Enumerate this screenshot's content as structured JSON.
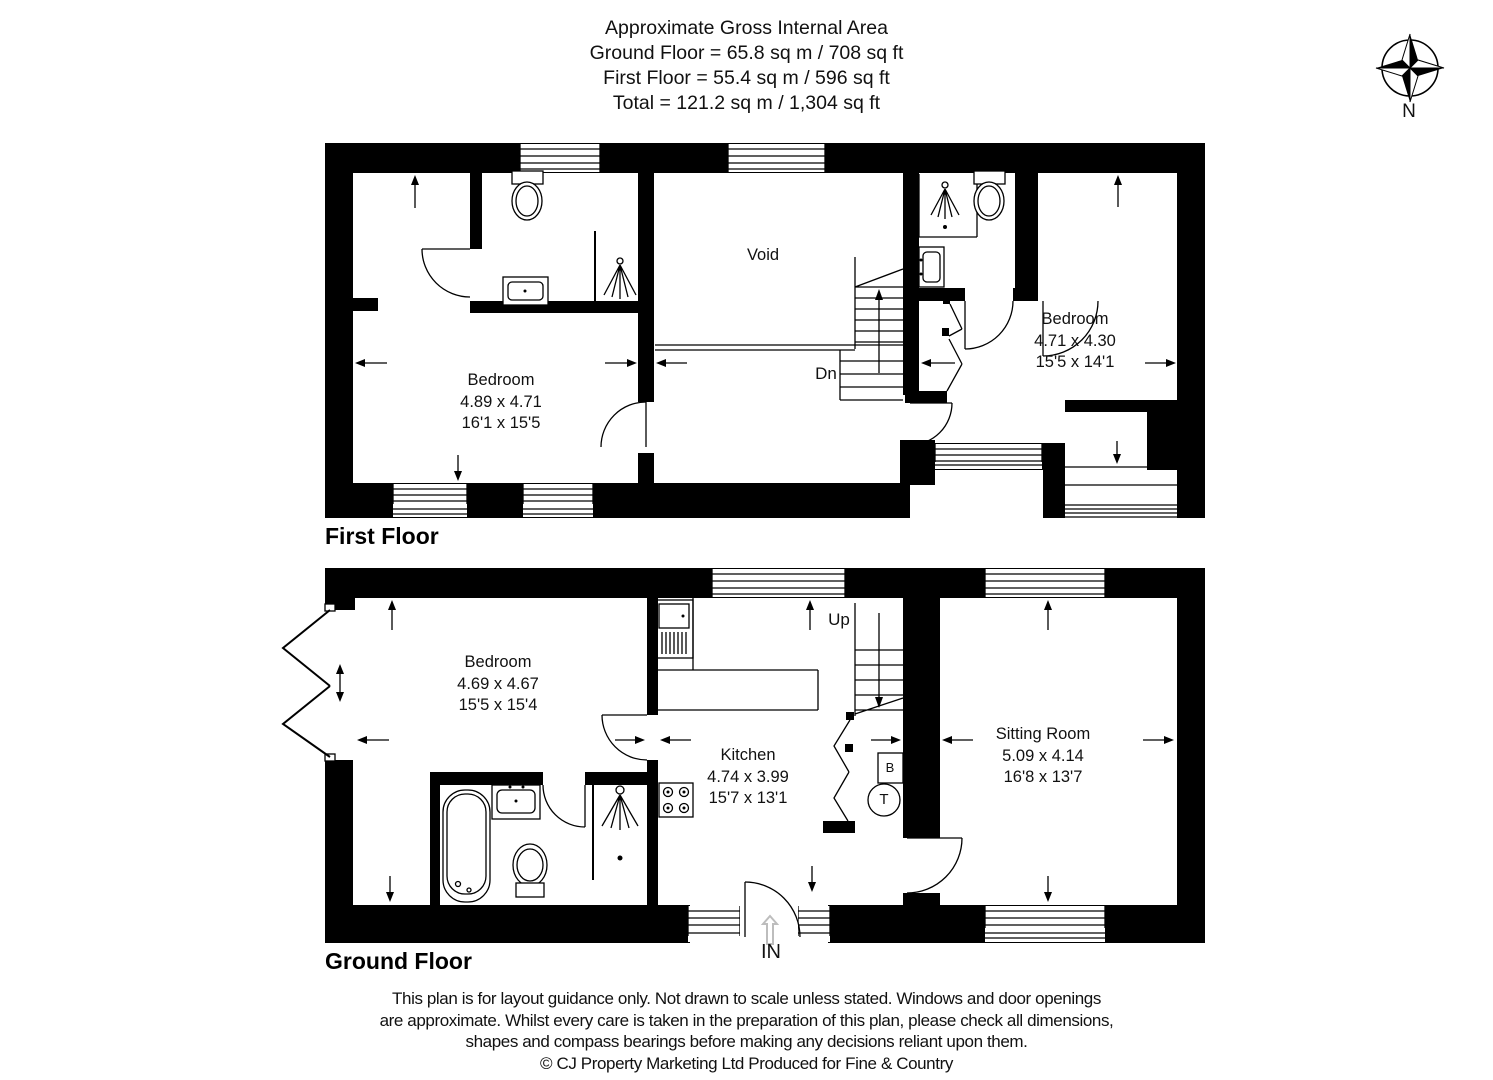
{
  "header": {
    "title": "Approximate Gross Internal Area",
    "ground_floor_area": "Ground Floor = 65.8 sq m / 708 sq ft",
    "first_floor_area": "First Floor = 55.4 sq m / 596 sq ft",
    "total_area": "Total = 121.2 sq m / 1,304 sq ft"
  },
  "compass": {
    "north_label": "N"
  },
  "first_floor": {
    "title": "First Floor",
    "stairs_label": "Dn",
    "rooms": {
      "bedroom_left": {
        "name": "Bedroom",
        "size_m": "4.89 x 4.71",
        "size_ft": "16'1 x 15'5"
      },
      "bedroom_right": {
        "name": "Bedroom",
        "size_m": "4.71 x 4.30",
        "size_ft": "15'5 x 14'1"
      },
      "void": {
        "name": "Void"
      }
    }
  },
  "ground_floor": {
    "title": "Ground Floor",
    "stairs_label": "Up",
    "entrance_label": "IN",
    "boiler_label": "B",
    "tank_label": "T",
    "rooms": {
      "bedroom": {
        "name": "Bedroom",
        "size_m": "4.69 x 4.67",
        "size_ft": "15'5 x 15'4"
      },
      "kitchen": {
        "name": "Kitchen",
        "size_m": "4.74 x 3.99",
        "size_ft": "15'7 x 13'1"
      },
      "sitting_room": {
        "name": "Sitting Room",
        "size_m": "5.09 x 4.14",
        "size_ft": "16'8 x 13'7"
      }
    }
  },
  "footer": {
    "line1": "This plan is for layout guidance only. Not drawn to scale unless stated. Windows and door openings",
    "line2": "are approximate. Whilst every care is taken in the preparation of this plan, please check all dimensions,",
    "line3": "shapes and compass bearings before making any decisions reliant upon them.",
    "copyright": "© CJ Property Marketing Ltd Produced for Fine & Country"
  },
  "colors": {
    "wall": "#000000",
    "background": "#ffffff",
    "ghost_arrow": "#bdbdbd"
  }
}
